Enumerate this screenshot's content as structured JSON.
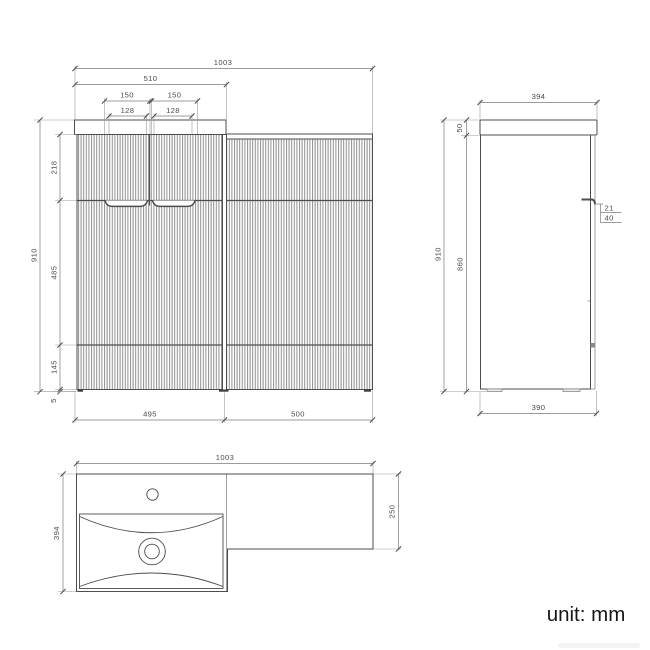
{
  "drawing": {
    "unit_note": "unit: mm",
    "front_view": {
      "overall_width": "1003",
      "basin_unit_top_width": "510",
      "handle_cutout_outer_left": "150",
      "handle_cutout_outer_right": "150",
      "handle_cutout_inner_left": "128",
      "handle_cutout_inner_right": "128",
      "drawer_height": "218",
      "overall_height": "910",
      "door_height": "485",
      "lower_panel_height": "145",
      "foot_height": "5",
      "left_unit_width": "495",
      "right_unit_width": "500"
    },
    "side_view": {
      "worktop_depth": "394",
      "worktop_thickness": "50",
      "overall_height": "910",
      "cabinet_height": "860",
      "handle_lip_depth": "21",
      "handle_recess_height": "40",
      "cabinet_depth": "390"
    },
    "plan_view": {
      "overall_width": "1003",
      "basin_unit_depth": "394",
      "side_unit_depth": "250"
    },
    "colors": {
      "line": "#4d4d4d",
      "dim": "#7a7a7a",
      "ext": "#9a9a9a",
      "text": "#4a4a4a",
      "flute": "#909090"
    }
  }
}
